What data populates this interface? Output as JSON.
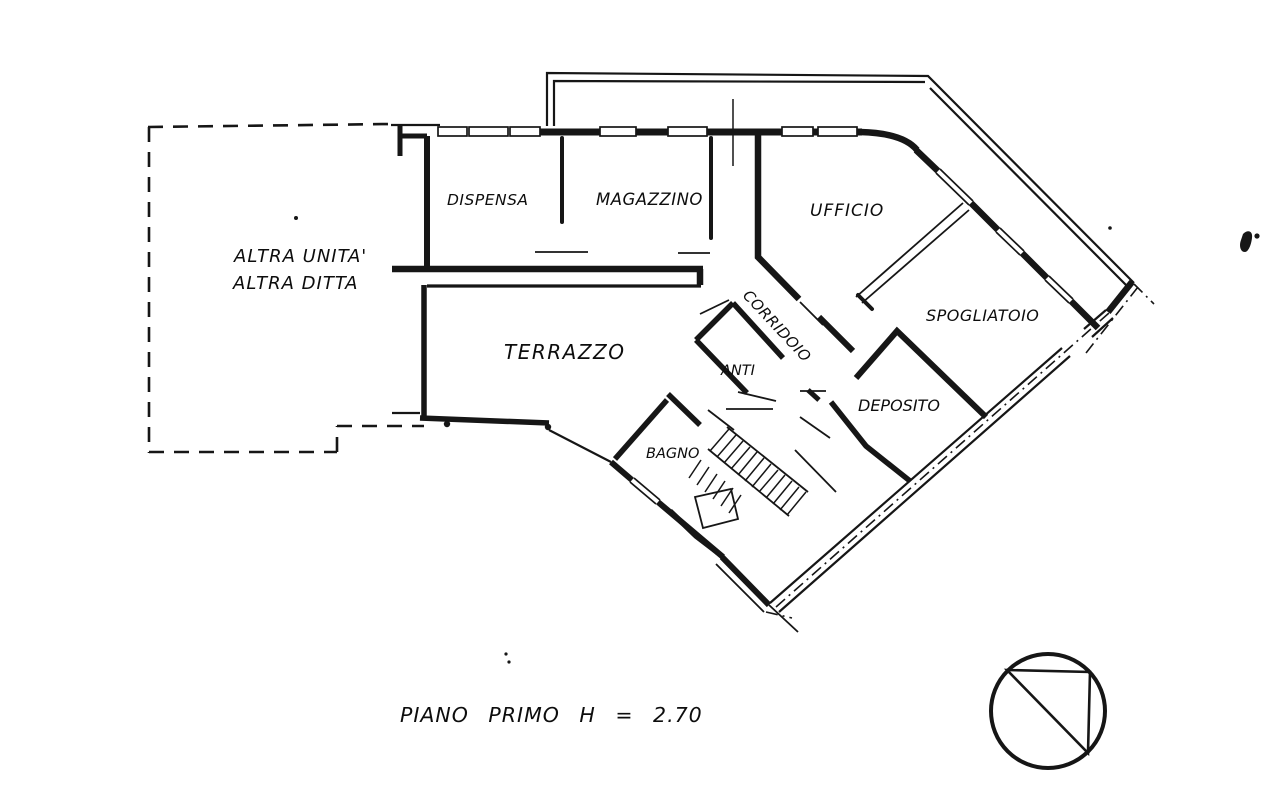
{
  "colors": {
    "ink": "#161616",
    "paper": "#ffffff"
  },
  "plan": {
    "floor_title": {
      "text": "PIANO PRIMO H = 2.70"
    },
    "labels": [
      {
        "id": "altra-unita-line-1",
        "text": "ALTRA UNITA'"
      },
      {
        "id": "altra-unita-line-2",
        "text": "ALTRA DITTA"
      },
      {
        "id": "dispensa",
        "text": "DISPENSA"
      },
      {
        "id": "magazzino",
        "text": "MAGAZZINO"
      },
      {
        "id": "ufficio",
        "text": "UFFICIO"
      },
      {
        "id": "spogliatoio",
        "text": "SPOGLIATOIO"
      },
      {
        "id": "corridoio",
        "text": "CORRIDOIO"
      },
      {
        "id": "anti",
        "text": "ANTI"
      },
      {
        "id": "deposito",
        "text": "DEPOSITO"
      },
      {
        "id": "bagno",
        "text": "BAGNO"
      },
      {
        "id": "terrazzo",
        "text": "TERRAZZO"
      }
    ],
    "stamp": {
      "symbol": "circle-with-inscribed-right-triangle"
    }
  }
}
